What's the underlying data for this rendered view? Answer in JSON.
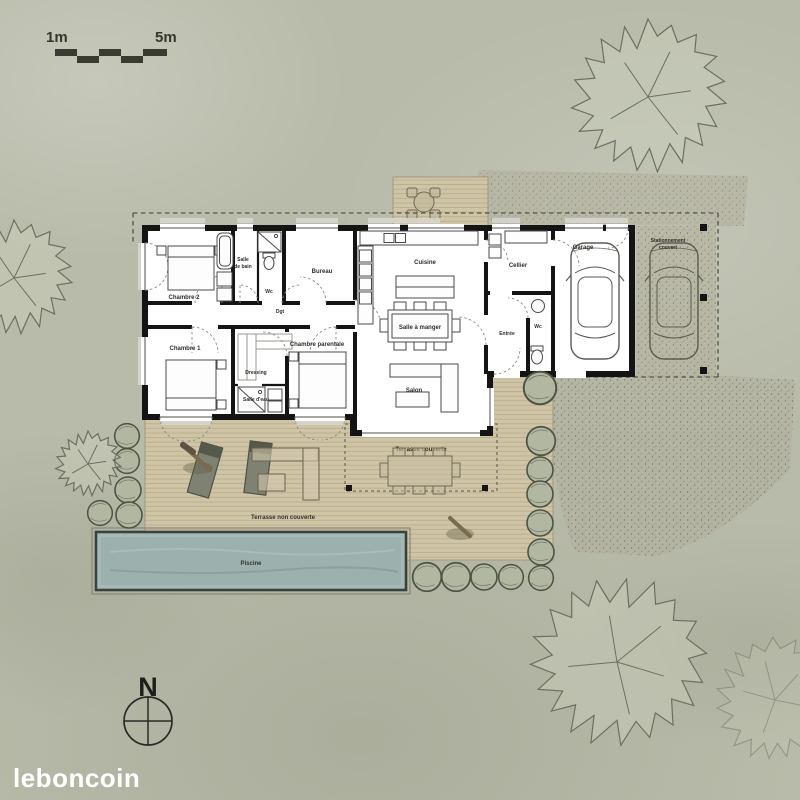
{
  "scale_bar": {
    "left_label": "1m",
    "right_label": "5m"
  },
  "rooms": {
    "chambre2": "Chambre 2",
    "salle_de_bain_l1": "Salle",
    "salle_de_bain_l2": "de bain",
    "wc_left": "Wc",
    "bureau": "Bureau",
    "dgt": "Dgt",
    "chambre1": "Chambre 1",
    "dressing": "Dressing",
    "salle_deau": "Salle d'eau",
    "chambre_parentale": "Chambre parentale",
    "cuisine": "Cuisine",
    "salle_a_manger": "Salle à manger",
    "salon": "Salon",
    "cellier": "Cellier",
    "entree": "Entrée",
    "wc_right": "Wc",
    "garage": "Garage",
    "stationnement_l1": "Stationnement",
    "stationnement_l2": "couvert"
  },
  "outdoor": {
    "terrasse_couverte": "Terrasse couverte",
    "terrasse_non_couverte": "Terrasse non couverte",
    "piscine": "Piscine"
  },
  "compass": {
    "north_label": "N"
  },
  "watermark": "leboncoin",
  "colors": {
    "background": "#b8bba9",
    "deck": "#cfc4a6",
    "pool_water": "#a7b9b7",
    "wall": "#141414",
    "label": "#2e2e2a",
    "watermark": "#ffffff"
  }
}
